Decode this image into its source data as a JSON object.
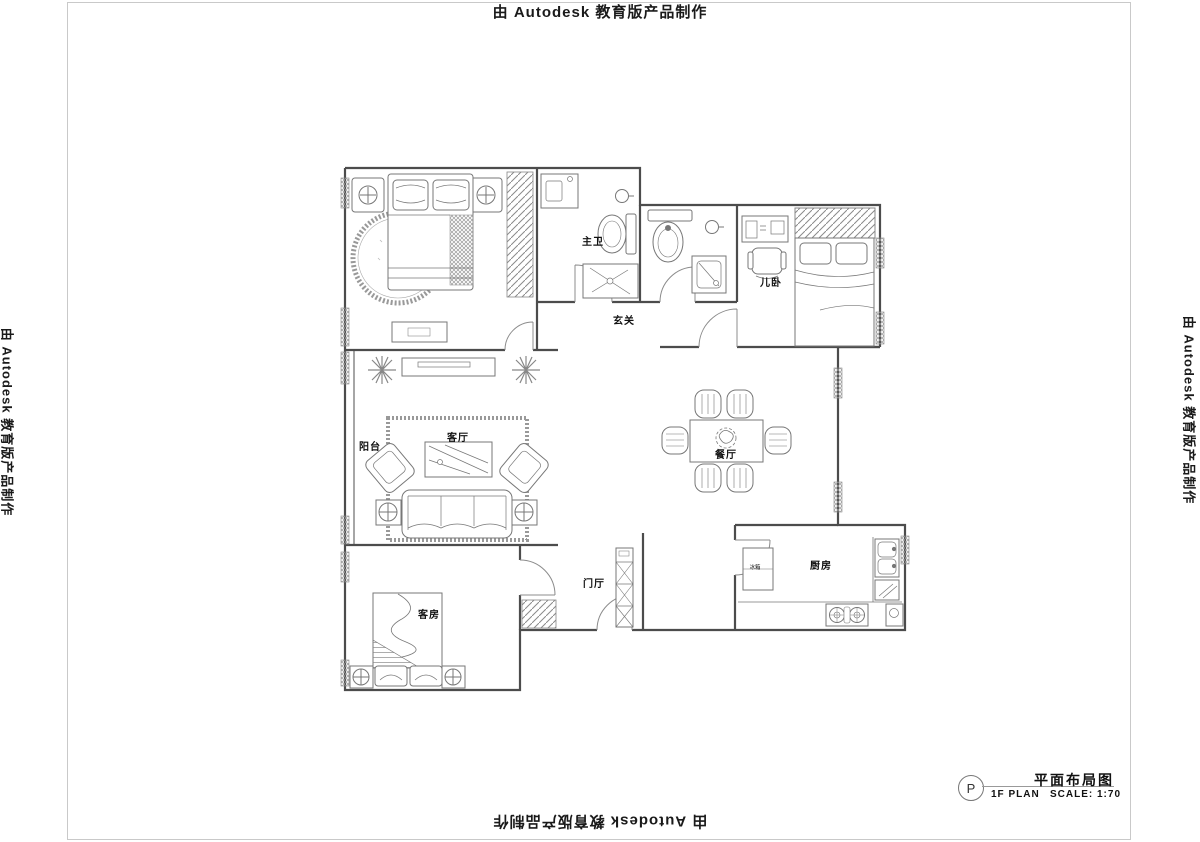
{
  "watermark": {
    "text": "由 Autodesk 教育版产品制作"
  },
  "title_block": {
    "symbol": "P",
    "plan_name": "平面布局图",
    "plan_code": "1F  PLAN",
    "scale": "SCALE: 1:70"
  },
  "rooms": {
    "master_bath": "主卫",
    "entry_hall": "玄关",
    "kids_bedroom": "儿卧",
    "balcony": "阳台",
    "living_room": "客厅",
    "dining_room": "餐厅",
    "foyer": "门厅",
    "kitchen": "厨房",
    "guest_room": "客房"
  },
  "labels": {
    "fridge": "冰箱"
  }
}
